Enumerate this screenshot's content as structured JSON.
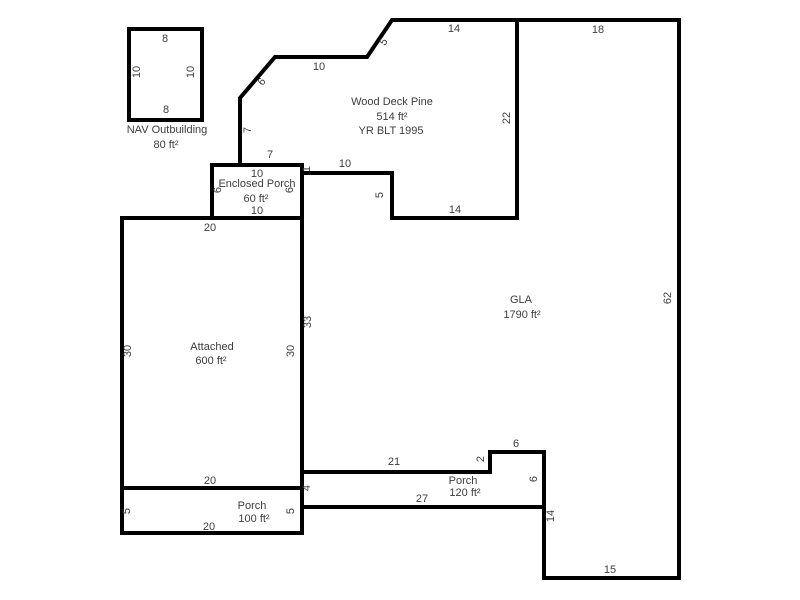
{
  "sketch": {
    "canvas": {
      "width": 800,
      "height": 600,
      "background": "#ffffff"
    },
    "style": {
      "wall_color": "#000000",
      "wall_width": 4,
      "text_color": "#3d3d3d",
      "font_size": 11
    },
    "rooms": [
      {
        "id": "nav-outbuilding",
        "title": "NAV Outbuilding",
        "area": "80 ft²",
        "points": [
          [
            129,
            29
          ],
          [
            202,
            29
          ],
          [
            202,
            120
          ],
          [
            129,
            120
          ]
        ],
        "texts": [
          {
            "name": "dimension-label",
            "t": "8",
            "x": 165,
            "y": 39,
            "r": 0
          },
          {
            "name": "dimension-label",
            "t": "10",
            "x": 137,
            "y": 72,
            "r": -90
          },
          {
            "name": "dimension-label",
            "t": "10",
            "x": 191,
            "y": 72,
            "r": -90
          },
          {
            "name": "dimension-label",
            "t": "8",
            "x": 166,
            "y": 110,
            "r": 0
          },
          {
            "name": "room-title",
            "t": "NAV Outbuilding",
            "x": 167,
            "y": 130,
            "r": 0
          },
          {
            "name": "room-area",
            "t": "80 ft²",
            "x": 166,
            "y": 145,
            "r": 0
          }
        ]
      },
      {
        "id": "wood-deck-pine",
        "title": "Wood Deck Pine",
        "area": "514 ft²",
        "year_built": "YR BLT 1995",
        "points": [
          [
            240,
            165
          ],
          [
            240,
            98
          ],
          [
            275,
            57
          ],
          [
            367,
            57
          ],
          [
            392,
            20
          ],
          [
            517,
            20
          ],
          [
            517,
            218
          ],
          [
            392,
            218
          ],
          [
            392,
            173
          ],
          [
            302,
            173
          ],
          [
            302,
            165
          ]
        ],
        "texts": [
          {
            "name": "dimension-label",
            "t": "6",
            "x": 262,
            "y": 82,
            "r": -50
          },
          {
            "name": "dimension-label",
            "t": "10",
            "x": 319,
            "y": 67,
            "r": 0
          },
          {
            "name": "dimension-label",
            "t": "5",
            "x": 384,
            "y": 42,
            "r": -56
          },
          {
            "name": "dimension-label",
            "t": "14",
            "x": 454,
            "y": 29,
            "r": 0
          },
          {
            "name": "dimension-label",
            "t": "22",
            "x": 507,
            "y": 118,
            "r": -90
          },
          {
            "name": "dimension-label",
            "t": "7",
            "x": 248,
            "y": 130,
            "r": -90
          },
          {
            "name": "dimension-label",
            "t": "7",
            "x": 270,
            "y": 155,
            "r": 0
          },
          {
            "name": "room-title",
            "t": "Wood Deck Pine",
            "x": 392,
            "y": 102,
            "r": 0
          },
          {
            "name": "room-area",
            "t": "514 ft²",
            "x": 392,
            "y": 117,
            "r": 0
          },
          {
            "name": "year-built-label",
            "t": "YR BLT 1995",
            "x": 391,
            "y": 131,
            "r": 0
          },
          {
            "name": "dimension-label",
            "t": "10",
            "x": 345,
            "y": 164,
            "r": 0
          },
          {
            "name": "dimension-label",
            "t": "1",
            "x": 307,
            "y": 169,
            "r": -90
          },
          {
            "name": "dimension-label",
            "t": "5",
            "x": 380,
            "y": 195,
            "r": -90
          },
          {
            "name": "dimension-label",
            "t": "14",
            "x": 455,
            "y": 210,
            "r": 0
          }
        ]
      },
      {
        "id": "enclosed-porch",
        "title": "Enclosed Porch",
        "area": "60 ft²",
        "points": [
          [
            212,
            165
          ],
          [
            302,
            165
          ],
          [
            302,
            218
          ],
          [
            212,
            218
          ]
        ],
        "texts": [
          {
            "name": "dimension-label",
            "t": "10",
            "x": 257,
            "y": 174,
            "r": 0
          },
          {
            "name": "room-title",
            "t": "Enclosed Porch",
            "x": 257,
            "y": 184,
            "r": 0
          },
          {
            "name": "room-area",
            "t": "60 ft²",
            "x": 256,
            "y": 199,
            "r": 0
          },
          {
            "name": "dimension-label",
            "t": "10",
            "x": 257,
            "y": 211,
            "r": 0
          },
          {
            "name": "dimension-label",
            "t": "6",
            "x": 218,
            "y": 190,
            "r": -90
          },
          {
            "name": "dimension-label",
            "t": "6",
            "x": 290,
            "y": 190,
            "r": -90
          }
        ]
      },
      {
        "id": "attached",
        "title": "Attached",
        "area": "600 ft²",
        "points": [
          [
            122,
            218
          ],
          [
            302,
            218
          ],
          [
            302,
            488
          ],
          [
            122,
            488
          ]
        ],
        "texts": [
          {
            "name": "dimension-label",
            "t": "20",
            "x": 210,
            "y": 228,
            "r": 0
          },
          {
            "name": "dimension-label",
            "t": "30",
            "x": 128,
            "y": 351,
            "r": -90
          },
          {
            "name": "dimension-label",
            "t": "30",
            "x": 291,
            "y": 351,
            "r": -90
          },
          {
            "name": "room-title",
            "t": "Attached",
            "x": 212,
            "y": 347,
            "r": 0
          },
          {
            "name": "room-area",
            "t": "600 ft²",
            "x": 211,
            "y": 361,
            "r": 0
          },
          {
            "name": "dimension-label",
            "t": "20",
            "x": 210,
            "y": 481,
            "r": 0
          }
        ]
      },
      {
        "id": "gla",
        "title": "GLA",
        "area": "1790 ft²",
        "points": [
          [
            302,
            173
          ],
          [
            392,
            173
          ],
          [
            392,
            218
          ],
          [
            517,
            218
          ],
          [
            517,
            20
          ],
          [
            679,
            20
          ],
          [
            679,
            578
          ],
          [
            544,
            578
          ],
          [
            544,
            452
          ],
          [
            490,
            452
          ],
          [
            490,
            472
          ],
          [
            302,
            472
          ]
        ],
        "texts": [
          {
            "name": "dimension-label",
            "t": "18",
            "x": 598,
            "y": 30,
            "r": 0
          },
          {
            "name": "dimension-label",
            "t": "62",
            "x": 668,
            "y": 298,
            "r": -90
          },
          {
            "name": "room-title",
            "t": "GLA",
            "x": 521,
            "y": 300,
            "r": 0
          },
          {
            "name": "room-area",
            "t": "1790 ft²",
            "x": 522,
            "y": 315,
            "r": 0
          },
          {
            "name": "dimension-label",
            "t": "33",
            "x": 308,
            "y": 322,
            "r": -90
          }
        ]
      },
      {
        "id": "porch-left",
        "title": "Porch",
        "area": "100 ft²",
        "points": [
          [
            122,
            488
          ],
          [
            302,
            488
          ],
          [
            302,
            533
          ],
          [
            122,
            533
          ]
        ],
        "texts": [
          {
            "name": "dimension-label",
            "t": "5",
            "x": 127,
            "y": 511,
            "r": -90
          },
          {
            "name": "room-title",
            "t": "Porch",
            "x": 252,
            "y": 506,
            "r": 0
          },
          {
            "name": "room-area",
            "t": "100 ft²",
            "x": 254,
            "y": 519,
            "r": 0
          },
          {
            "name": "dimension-label",
            "t": "20",
            "x": 209,
            "y": 527,
            "r": 0
          },
          {
            "name": "dimension-label",
            "t": "5",
            "x": 291,
            "y": 511,
            "r": -90
          }
        ]
      },
      {
        "id": "porch-right",
        "title": "Porch",
        "area": "120 ft²",
        "points": [
          [
            302,
            472
          ],
          [
            490,
            472
          ],
          [
            490,
            452
          ],
          [
            544,
            452
          ],
          [
            544,
            507
          ],
          [
            302,
            507
          ]
        ],
        "texts": [
          {
            "name": "dimension-label",
            "t": "21",
            "x": 394,
            "y": 462,
            "r": 0
          },
          {
            "name": "dimension-label",
            "t": "2",
            "x": 481,
            "y": 459,
            "r": -90
          },
          {
            "name": "dimension-label",
            "t": "6",
            "x": 516,
            "y": 444,
            "r": 0
          },
          {
            "name": "dimension-label",
            "t": "4",
            "x": 307,
            "y": 488,
            "r": -90
          },
          {
            "name": "room-title",
            "t": "Porch",
            "x": 463,
            "y": 481,
            "r": 0
          },
          {
            "name": "room-area",
            "t": "120 ft²",
            "x": 465,
            "y": 493,
            "r": 0
          },
          {
            "name": "dimension-label",
            "t": "27",
            "x": 422,
            "y": 499,
            "r": 0
          },
          {
            "name": "dimension-label",
            "t": "6",
            "x": 534,
            "y": 479,
            "r": -90
          },
          {
            "name": "dimension-label",
            "t": "14",
            "x": 551,
            "y": 516,
            "r": -90
          },
          {
            "name": "dimension-label",
            "t": "15",
            "x": 610,
            "y": 570,
            "r": 0
          }
        ]
      }
    ]
  }
}
